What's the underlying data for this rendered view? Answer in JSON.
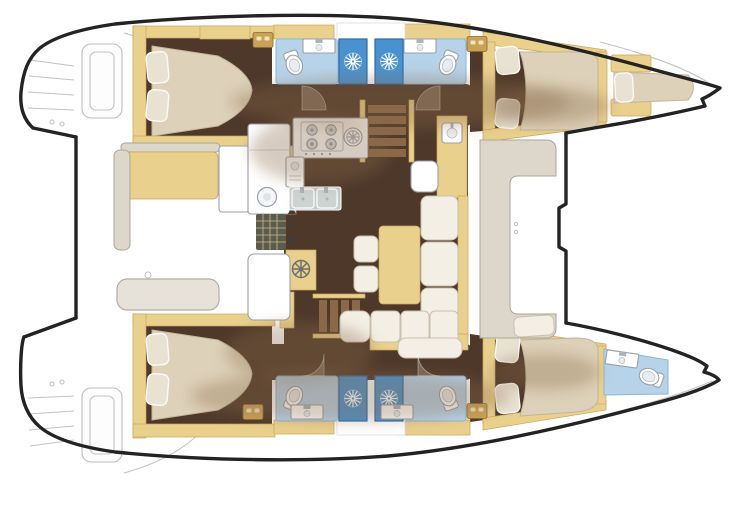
{
  "canvas": {
    "width": 733,
    "height": 506
  },
  "palette": {
    "outline": "#232323",
    "hull_fill": "#ffffff",
    "deck_line": "#c3c3c3",
    "floor": "#4e382a",
    "wood": "#e9d08d",
    "bed": "#ddd1b9",
    "pillow": "#e9e2d3",
    "bath_floor": "#b7d3ea",
    "shower": "#4a92cf",
    "haze": "#8a6a4a",
    "seat_white": "#f4efe5",
    "bench_gray": "#dcd6cb",
    "steel": "#c6cdc9",
    "mat": "#5c5c4e"
  },
  "vessel": {
    "kind": "catamaran-floor-plan",
    "orientation": "bow-right",
    "decks": {
      "port_hull": [
        "aft-double-cabin",
        "aft-head-with-shower",
        "fwd-head-with-shower",
        "fwd-double-cabin",
        "bow-crew-berth"
      ],
      "bridge_deck": [
        "aft-cockpit",
        "galley",
        "chart-area",
        "dinette-settee",
        "fwd-cockpit-bench"
      ],
      "starboard_hull": [
        "aft-double-cabin",
        "aft-head-with-shower",
        "fwd-head-with-shower",
        "fwd-double-cabin",
        "bow-head"
      ]
    },
    "fixtures": [
      "double-bed",
      "pillows",
      "shower-stall",
      "toilet",
      "washbasin",
      "stove-4-burner",
      "extractor-fan",
      "double-sink",
      "fridge",
      "companionway-stairs",
      "dinette-table",
      "settee",
      "stools",
      "cockpit-table",
      "cockpit-bench",
      "wet-bar-sink",
      "hatch-mat",
      "helm-wheel",
      "wardrobe-drawers",
      "transom-steps"
    ]
  }
}
